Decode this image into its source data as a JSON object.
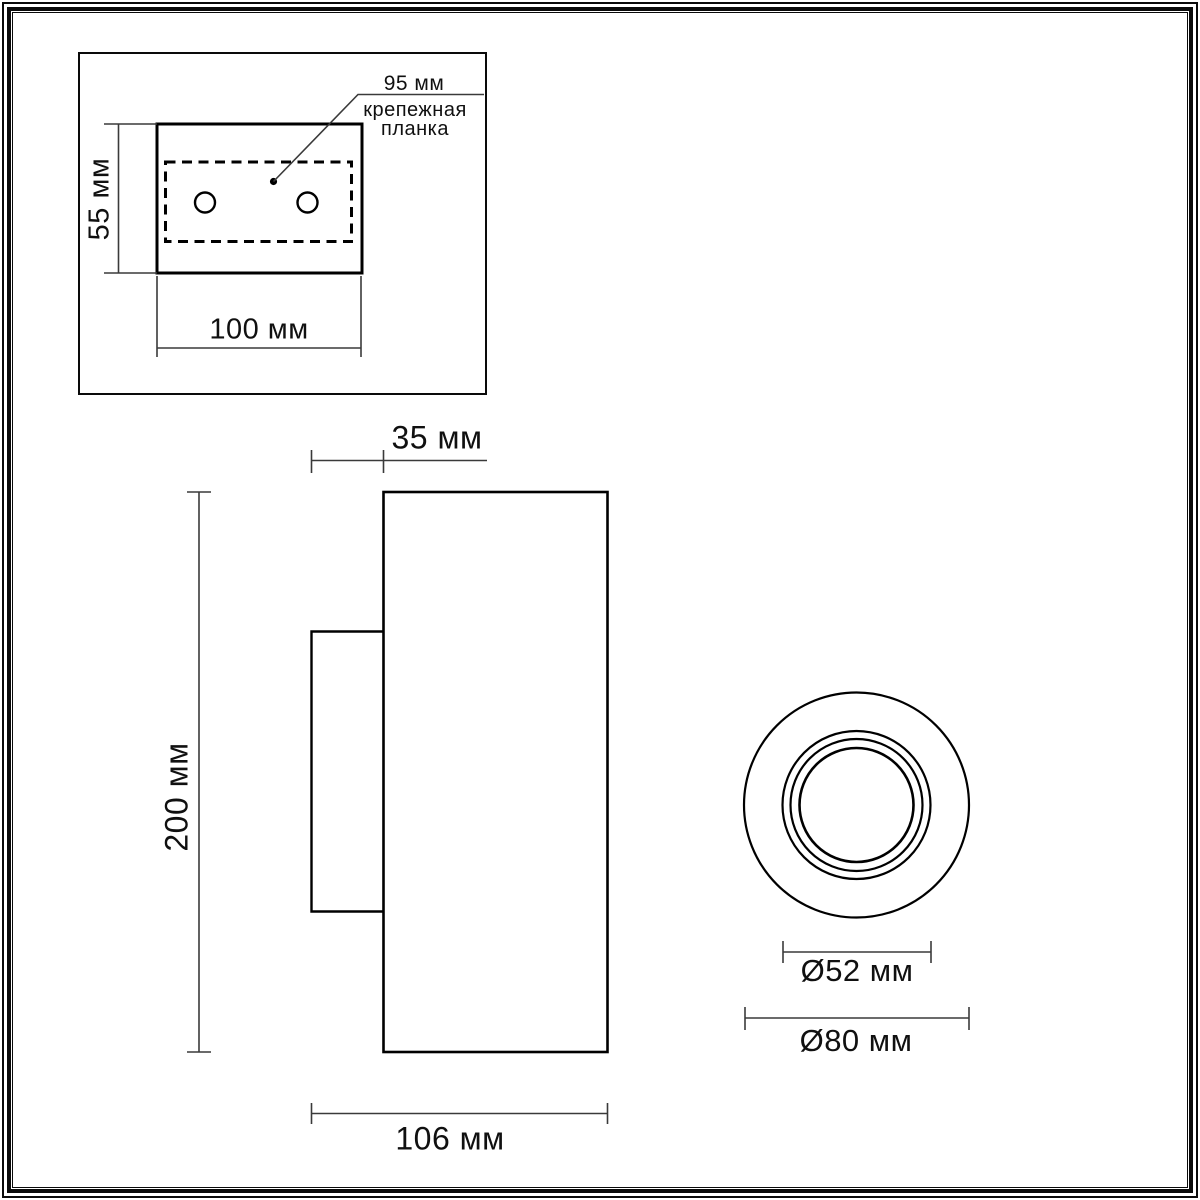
{
  "colors": {
    "background": "#ffffff",
    "outline": "#000000",
    "dimension_line": "#3a3a3a",
    "text": "#101010",
    "frame": "#0a0a0a"
  },
  "mounting_plate_view": {
    "bar_length_label": "95 мм",
    "bar_name_line1": "крепежная",
    "bar_name_line2": "планка",
    "height_label": "55 мм",
    "width_label": "100 мм"
  },
  "side_view": {
    "bracket_depth_label": "35 мм",
    "height_label": "200 мм",
    "depth_label": "106 мм"
  },
  "front_view": {
    "inner_diameter_label": "Ø52 мм",
    "outer_diameter_label": "Ø80 мм"
  }
}
